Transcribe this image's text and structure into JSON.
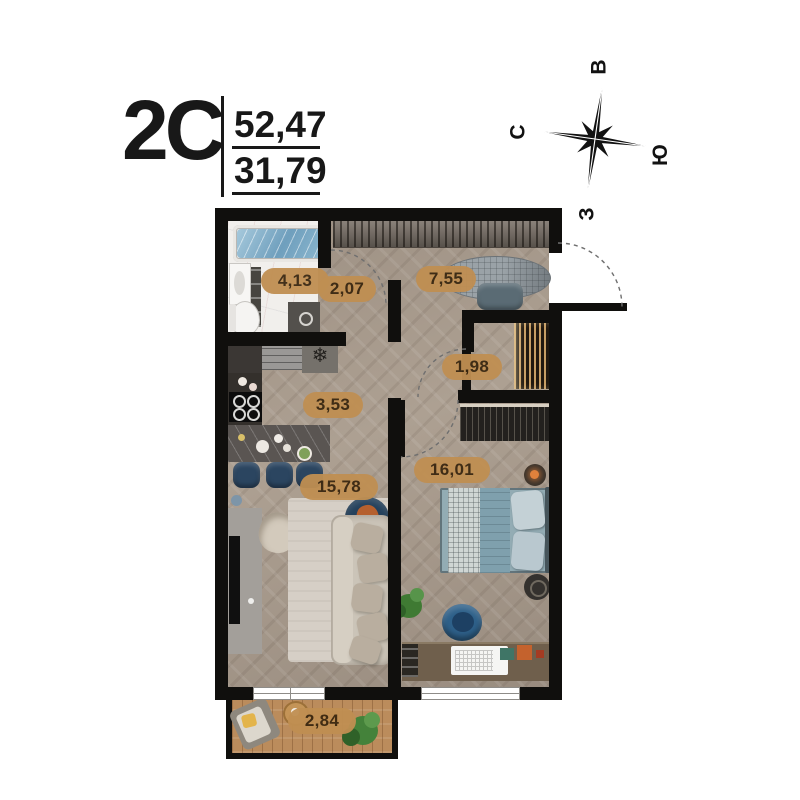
{
  "title": {
    "apartment_type": "2C",
    "total_area": "52,47",
    "living_area": "31,79"
  },
  "compass": {
    "east": "В",
    "north": "С",
    "south": "Ю",
    "west": "З"
  },
  "rooms": [
    {
      "name": "bathroom",
      "area": "4,13"
    },
    {
      "name": "hallway",
      "area": "2,07"
    },
    {
      "name": "entrance-hall",
      "area": "7,55"
    },
    {
      "name": "closet",
      "area": "1,98"
    },
    {
      "name": "kitchen",
      "area": "3,53"
    },
    {
      "name": "living-room",
      "area": "15,78"
    },
    {
      "name": "bedroom",
      "area": "16,01"
    },
    {
      "name": "balcony",
      "area": "2,84"
    }
  ],
  "icons": {
    "snowflake": "❄"
  },
  "colors": {
    "wall": "#100f0d",
    "label_bg": "#c08f52",
    "label_text": "#3a2710",
    "floor_parquet": "#a79a8d",
    "accent_navy": "#2b4560",
    "bed_teal": "#7fa0ad",
    "deck_wood": "#bb8c5c"
  }
}
